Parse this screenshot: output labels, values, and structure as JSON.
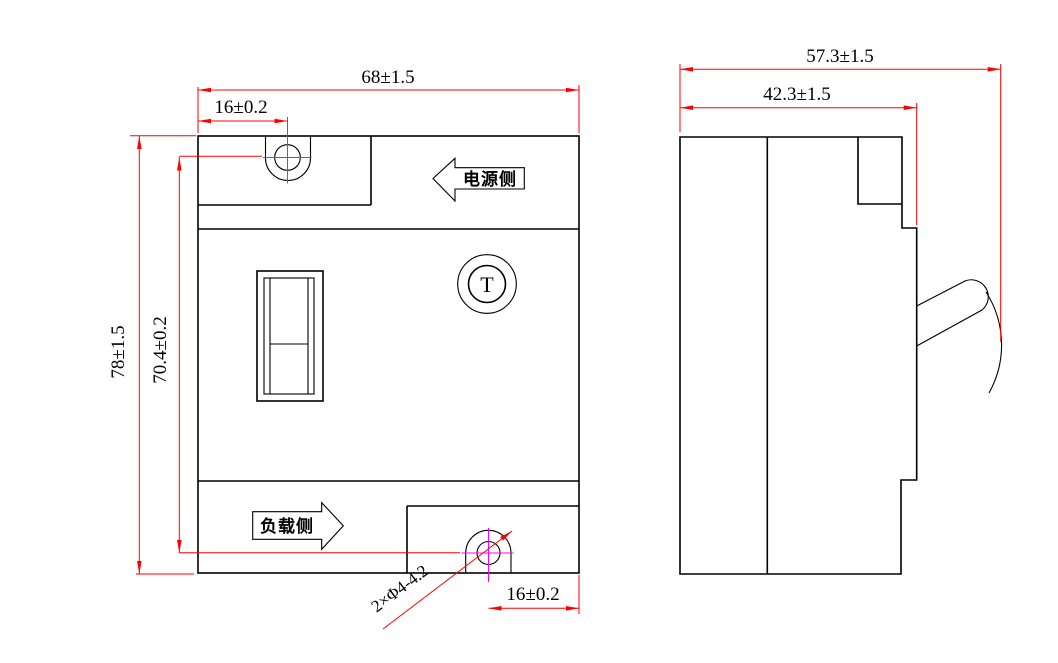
{
  "front_view": {
    "dim_overall_width": "68±1.5",
    "dim_top_hole_offset": "16±0.2",
    "dim_overall_height": "78±1.5",
    "dim_hole_spacing": "70.4±0.2",
    "dim_bottom_hole_offset": "16±0.2",
    "mounting_hole_callout": "2×Φ4-4.2",
    "power_side_label": "电源侧",
    "load_side_label": "负载侧",
    "test_button_label": "T"
  },
  "side_view": {
    "dim_overall_depth": "57.3±1.5",
    "dim_body_depth": "42.3±1.5"
  },
  "colors": {
    "outline": "#000000",
    "dimension": "#ff0000",
    "centerline": "#ff00ff",
    "background": "#ffffff"
  }
}
